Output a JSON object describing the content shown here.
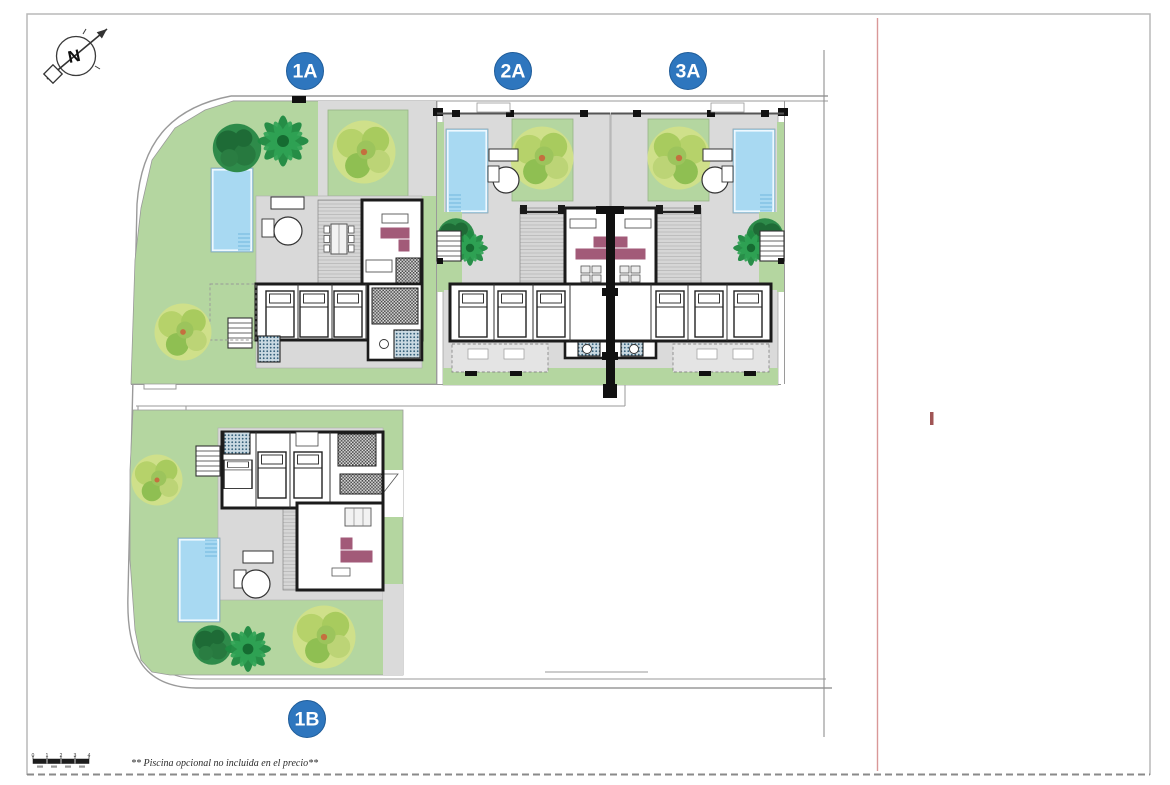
{
  "compass": {
    "letter": "N"
  },
  "unit_badges": [
    "1A",
    "2A",
    "3A",
    "1B"
  ],
  "footer": {
    "disclaimer": "** Piscina opcional no incluida en el precio**",
    "scale_ticks": [
      "0",
      "1",
      "2",
      "3",
      "4"
    ]
  },
  "colors": {
    "badge_blue": "#2e76be",
    "lawn_green": "#b4d6a0",
    "pool_blue": "#a8d9f2",
    "terrace_grey": "#d9d9d9",
    "sofa_plum": "#a25a78",
    "wall_black": "#1b1b1b",
    "boundary_red": "#d99898",
    "tick_red": "#a05555"
  }
}
